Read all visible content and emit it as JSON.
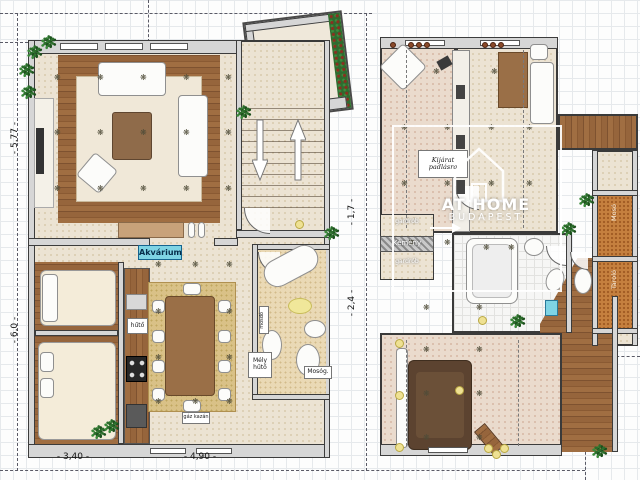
{
  "watermark": {
    "brand": "AT HOME",
    "city": "BUDAPEST"
  },
  "dimensions": {
    "left_upper_height": "- 5,77 -",
    "left_lower_height": "- 6,0 -",
    "bottom_left_width": "- 3,40 -",
    "bottom_right_width": "- 4,90 -",
    "mid_upper_height": "- 1,7 -",
    "mid_lower_height": "- 2,4 -"
  },
  "labels": {
    "aquarium": "Akvárium",
    "fridge": "hűtő",
    "freezer_l1": "Mély",
    "freezer_l2": "hűtő",
    "washer": "Mosóg.",
    "boiler": "gáz kazán",
    "basin": "mosdó",
    "attic_l1": "Kijárat",
    "attic_l2": "padlásra",
    "wardrobe_top": "gardrób",
    "chimney": "Kémény",
    "wardrobe_bottom": "gardrób",
    "laundry": "Mosó",
    "storage": "Tároló"
  },
  "colors": {
    "wall": "#d6d6d6",
    "wood": "#96653c",
    "floor_cream": "#ece3d3",
    "accent_cyan": "#7fd4e4",
    "plant_green": "#2c6e2c",
    "watermark_white": "#ffffff"
  },
  "decor": {
    "flower_glyph": "❋",
    "plant_glyph": "✻",
    "flowers": [
      [
        58,
        78
      ],
      [
        101,
        78
      ],
      [
        144,
        78
      ],
      [
        187,
        78
      ],
      [
        229,
        78
      ],
      [
        58,
        133
      ],
      [
        101,
        133
      ],
      [
        144,
        133
      ],
      [
        187,
        133
      ],
      [
        229,
        133
      ],
      [
        58,
        189
      ],
      [
        101,
        189
      ],
      [
        144,
        189
      ],
      [
        187,
        189
      ],
      [
        229,
        189
      ],
      [
        159,
        265
      ],
      [
        196,
        265
      ],
      [
        230,
        265
      ],
      [
        159,
        312
      ],
      [
        230,
        312
      ],
      [
        159,
        358
      ],
      [
        230,
        358
      ],
      [
        159,
        402
      ],
      [
        196,
        402
      ],
      [
        230,
        402
      ],
      [
        437,
        72
      ],
      [
        495,
        72
      ],
      [
        405,
        128
      ],
      [
        448,
        128
      ],
      [
        492,
        128
      ],
      [
        530,
        128
      ],
      [
        405,
        184
      ],
      [
        448,
        184
      ],
      [
        492,
        184
      ],
      [
        530,
        184
      ],
      [
        412,
        243
      ],
      [
        448,
        243
      ],
      [
        487,
        248
      ],
      [
        512,
        248
      ],
      [
        427,
        308
      ],
      [
        480,
        308
      ],
      [
        427,
        350
      ],
      [
        480,
        350
      ],
      [
        427,
        394
      ],
      [
        480,
        394
      ],
      [
        427,
        438
      ],
      [
        480,
        438
      ]
    ],
    "lamps": [
      [
        399,
        343
      ],
      [
        399,
        395
      ],
      [
        399,
        447
      ],
      [
        459,
        390
      ],
      [
        482,
        320
      ],
      [
        299,
        224
      ],
      [
        488,
        448
      ],
      [
        496,
        454
      ],
      [
        504,
        448
      ]
    ],
    "plants": [
      [
        36,
        52
      ],
      [
        28,
        70
      ],
      [
        50,
        42
      ],
      [
        30,
        92
      ],
      [
        100,
        432
      ],
      [
        113,
        426
      ],
      [
        333,
        233
      ],
      [
        245,
        112
      ],
      [
        588,
        200
      ],
      [
        570,
        229
      ],
      [
        519,
        321
      ],
      [
        601,
        451
      ]
    ],
    "roof_dots": [
      [
        390,
        42
      ],
      [
        408,
        42
      ],
      [
        416,
        42
      ],
      [
        424,
        42
      ],
      [
        482,
        42
      ],
      [
        490,
        42
      ],
      [
        498,
        42
      ]
    ]
  }
}
